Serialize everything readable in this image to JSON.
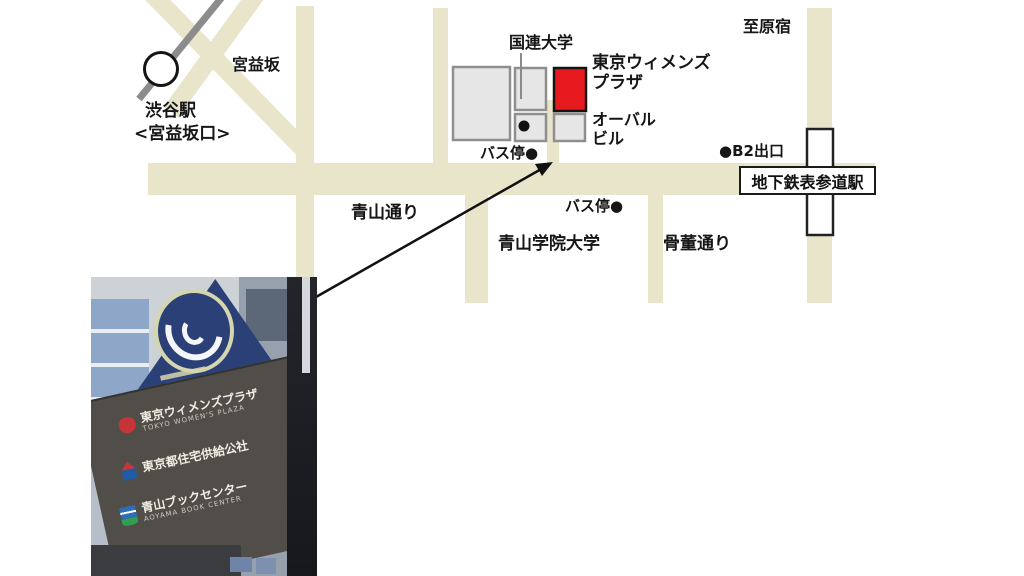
{
  "map": {
    "labels": {
      "miyamasuzaka": "宮益坂",
      "shibuya_station": "渋谷駅",
      "miyamasuzaka_exit": "<宮益坂口>",
      "un_university": "国連大学",
      "womens_plaza": {
        "line1": "東京ウィメンズ",
        "line2": "プラザ"
      },
      "oval_building": {
        "line1": "オーバル",
        "line2": "ビル"
      },
      "bus_stop_upper": "バス停●",
      "to_harajuku": "至原宿",
      "b2_exit": "●B2出口",
      "subway_omotesando_station": "地下鉄表参道駅",
      "aoyama_dori": "青山通り",
      "bus_stop_lower": "バス停●",
      "aoyama_gakuin_univ": "青山学院大学",
      "kotto_dori": "骨董通り"
    },
    "colors": {
      "road_beige": "#e9e5ca",
      "building_gray": "#e6e6e6",
      "building_border": "#8f8f8f",
      "plaza_red": "#e6191e",
      "railway_gray": "#8c8c8c"
    }
  },
  "photo": {
    "direction_plate_arrow": "←",
    "sign_rows": [
      {
        "name": "東京ウィメンズプラザ",
        "sub": "TOKYO WOMEN'S PLAZA"
      },
      {
        "name": "東京都住宅供給公社"
      },
      {
        "name": "青山ブックセンター",
        "sub": "AOYAMA BOOK CENTER"
      }
    ],
    "colors": {
      "sign_navy": "#2c4078",
      "board_gray": "#514e4a"
    }
  }
}
